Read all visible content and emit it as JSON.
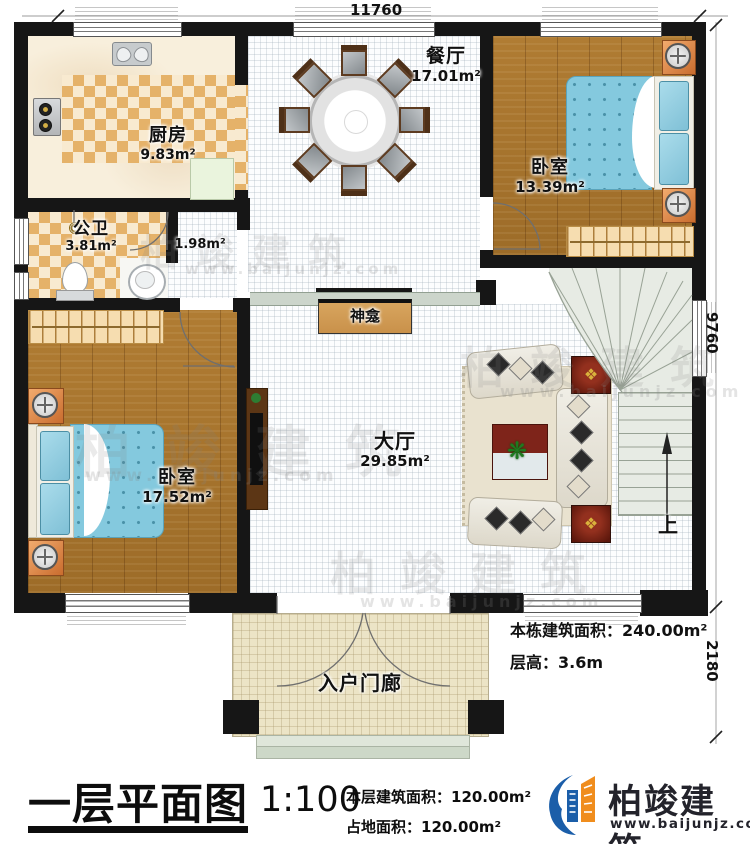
{
  "plan": {
    "dim_top": "11760",
    "dim_right_upper": "9760",
    "dim_right_lower": "2180",
    "rooms": {
      "kitchen": {
        "name": "厨房",
        "area": "9.83m²"
      },
      "bath": {
        "name": "公卫",
        "area": "3.81m²"
      },
      "corridor": {
        "area": "1.98m²"
      },
      "dining": {
        "name": "餐厅",
        "area": "17.01m²"
      },
      "bedroom1": {
        "name": "卧室",
        "area": "13.39m²"
      },
      "bedroom2": {
        "name": "卧室",
        "area": "17.52m²"
      },
      "hall": {
        "name": "大厅",
        "area": "29.85m²"
      },
      "shrine": {
        "name": "神龛"
      },
      "porch": {
        "name": "入户门廊"
      },
      "stairs": {
        "up_label": "上"
      }
    },
    "notes": {
      "total_area": "本栋建筑面积：240.00m²",
      "floor_height": "层高：3.6m"
    }
  },
  "titleblock": {
    "title": "一层平面图",
    "scale": "1:100",
    "floor_area": "本层建筑面积：120.00m²",
    "footprint": "占地面积：120.00m²"
  },
  "brand": {
    "name": "柏竣建筑",
    "site": "www.baijunjz.com"
  },
  "watermark": {
    "text": "柏竣建筑",
    "site": "www.baijunjz.com"
  },
  "colors": {
    "wall": "#161616",
    "wood_floor": "#a9752e",
    "tile_checker": "#e5b269",
    "bed_blue": "#84c9de",
    "shrine": "#cf9851",
    "stairs": "#e7ebe4",
    "porch": "#ece4c6",
    "brand_blue": "#1b5ea9",
    "brand_orange": "#f08d1d"
  }
}
